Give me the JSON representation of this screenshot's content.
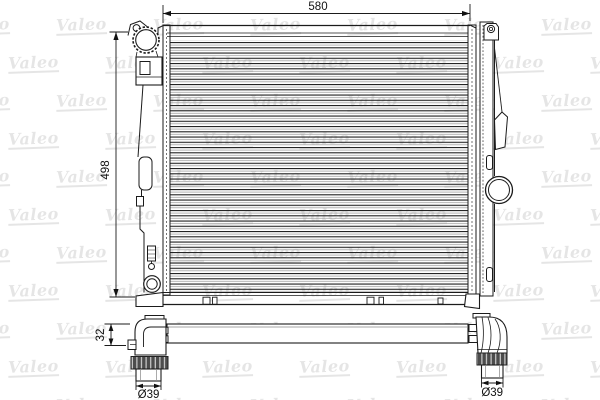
{
  "watermark": {
    "text": "Valeo",
    "color": "rgba(0,0,0,0.10)"
  },
  "drawing": {
    "subject": "radiator technical drawing",
    "brand": "Valeo",
    "line_color": "#1b1b1b",
    "views": [
      "front",
      "side",
      "bottom"
    ],
    "dimensions": {
      "overall_width": "580",
      "overall_height": "498",
      "outlet_height": "32",
      "left_pipe_diameter": "Ø39",
      "right_pipe_diameter": "Ø39"
    }
  }
}
